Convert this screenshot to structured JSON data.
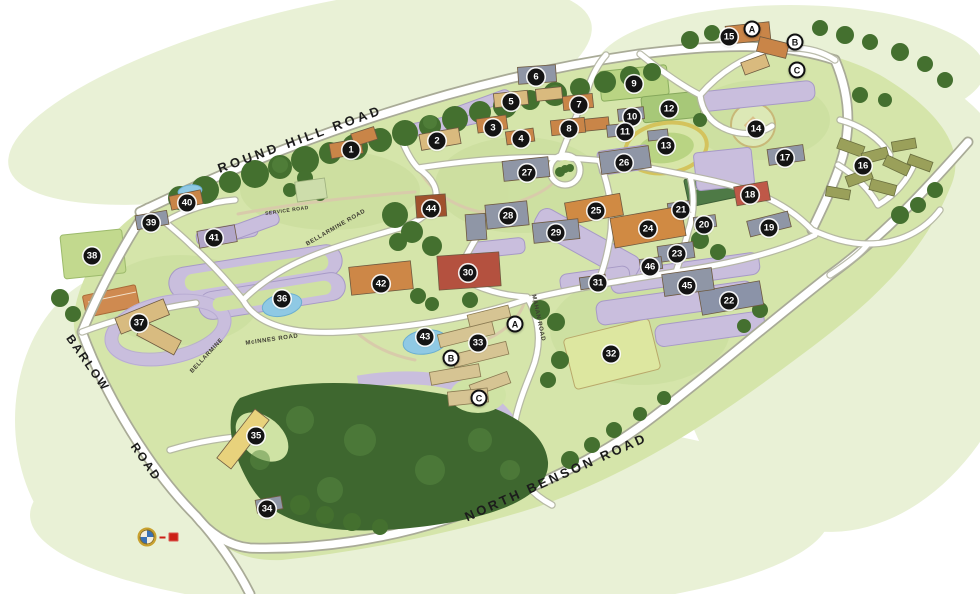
{
  "map": {
    "name": "illustrated-campus-map",
    "palette": {
      "wash": "#e9f1d6",
      "ground": "#d5e5aa",
      "forest": "#3e672f",
      "tree": "#44702f",
      "road_casing": "#a9ab97",
      "road": "#ffffff",
      "parking": "#c9bedd",
      "building_orange": "#c98548",
      "building_tan": "#d9ba7e",
      "building_slate": "#8f96a6",
      "building_red": "#bf5848",
      "pond": "#8fc9e4",
      "track": "#d4c35c",
      "marker_bg": "#141414"
    },
    "road_labels": [
      {
        "text": "ROUND HILL ROAD",
        "x": 300,
        "y": 139,
        "rot": -20,
        "size": 13,
        "spacing": 3.5,
        "cls": "major"
      },
      {
        "text": "NORTH BENSON ROAD",
        "x": 556,
        "y": 477,
        "rot": -24,
        "size": 13,
        "spacing": 3,
        "cls": "major"
      },
      {
        "text": "BARLOW",
        "x": 88,
        "y": 363,
        "rot": 55,
        "size": 12,
        "spacing": 2,
        "cls": "major"
      },
      {
        "text": "ROAD",
        "x": 146,
        "y": 462,
        "rot": 55,
        "size": 12,
        "spacing": 2,
        "cls": "major"
      },
      {
        "text": "BELLARMINE ROAD",
        "x": 336,
        "y": 228,
        "rot": -30,
        "size": 6,
        "spacing": 0.6,
        "cls": "minor"
      },
      {
        "text": "SERVICE ROAD",
        "x": 287,
        "y": 211,
        "rot": -8,
        "size": 5,
        "spacing": 0.5,
        "cls": "minor"
      },
      {
        "text": "BELLARMINE",
        "x": 207,
        "y": 356,
        "rot": -47,
        "size": 6,
        "spacing": 0.6,
        "cls": "minor"
      },
      {
        "text": "McINNES ROAD",
        "x": 272,
        "y": 340,
        "rot": -8,
        "size": 6,
        "spacing": 0.6,
        "cls": "minor"
      },
      {
        "text": "MAHAN ROAD",
        "x": 538,
        "y": 318,
        "rot": 78,
        "size": 6,
        "spacing": 0.6,
        "cls": "minor"
      }
    ],
    "markers": [
      {
        "label": "1",
        "x": 351,
        "y": 150,
        "type": "number"
      },
      {
        "label": "2",
        "x": 437,
        "y": 141,
        "type": "number"
      },
      {
        "label": "3",
        "x": 493,
        "y": 128,
        "type": "number"
      },
      {
        "label": "4",
        "x": 521,
        "y": 139,
        "type": "number"
      },
      {
        "label": "5",
        "x": 511,
        "y": 102,
        "type": "number"
      },
      {
        "label": "6",
        "x": 536,
        "y": 77,
        "type": "number"
      },
      {
        "label": "7",
        "x": 579,
        "y": 105,
        "type": "number"
      },
      {
        "label": "8",
        "x": 569,
        "y": 129,
        "type": "number"
      },
      {
        "label": "9",
        "x": 634,
        "y": 84,
        "type": "number"
      },
      {
        "label": "10",
        "x": 632,
        "y": 117,
        "type": "number"
      },
      {
        "label": "11",
        "x": 625,
        "y": 132,
        "type": "number"
      },
      {
        "label": "12",
        "x": 669,
        "y": 109,
        "type": "number"
      },
      {
        "label": "13",
        "x": 666,
        "y": 146,
        "type": "number"
      },
      {
        "label": "14",
        "x": 756,
        "y": 129,
        "type": "number"
      },
      {
        "label": "15",
        "x": 729,
        "y": 37,
        "type": "number"
      },
      {
        "label": "16",
        "x": 863,
        "y": 166,
        "type": "number"
      },
      {
        "label": "17",
        "x": 785,
        "y": 158,
        "type": "number"
      },
      {
        "label": "18",
        "x": 750,
        "y": 195,
        "type": "number"
      },
      {
        "label": "19",
        "x": 769,
        "y": 228,
        "type": "number"
      },
      {
        "label": "20",
        "x": 704,
        "y": 225,
        "type": "number"
      },
      {
        "label": "21",
        "x": 681,
        "y": 210,
        "type": "number"
      },
      {
        "label": "22",
        "x": 729,
        "y": 301,
        "type": "number"
      },
      {
        "label": "23",
        "x": 677,
        "y": 254,
        "type": "number"
      },
      {
        "label": "24",
        "x": 648,
        "y": 229,
        "type": "number"
      },
      {
        "label": "25",
        "x": 596,
        "y": 211,
        "type": "number"
      },
      {
        "label": "26",
        "x": 624,
        "y": 163,
        "type": "number"
      },
      {
        "label": "27",
        "x": 527,
        "y": 173,
        "type": "number"
      },
      {
        "label": "28",
        "x": 508,
        "y": 216,
        "type": "number"
      },
      {
        "label": "29",
        "x": 556,
        "y": 233,
        "type": "number"
      },
      {
        "label": "30",
        "x": 468,
        "y": 273,
        "type": "number"
      },
      {
        "label": "31",
        "x": 598,
        "y": 283,
        "type": "number"
      },
      {
        "label": "32",
        "x": 611,
        "y": 354,
        "type": "number"
      },
      {
        "label": "33",
        "x": 478,
        "y": 343,
        "type": "number"
      },
      {
        "label": "34",
        "x": 267,
        "y": 509,
        "type": "number"
      },
      {
        "label": "35",
        "x": 256,
        "y": 436,
        "type": "number"
      },
      {
        "label": "36",
        "x": 282,
        "y": 299,
        "type": "number"
      },
      {
        "label": "37",
        "x": 139,
        "y": 323,
        "type": "number"
      },
      {
        "label": "38",
        "x": 92,
        "y": 256,
        "type": "number"
      },
      {
        "label": "39",
        "x": 151,
        "y": 223,
        "type": "number"
      },
      {
        "label": "40",
        "x": 187,
        "y": 203,
        "type": "number"
      },
      {
        "label": "41",
        "x": 214,
        "y": 238,
        "type": "number"
      },
      {
        "label": "42",
        "x": 381,
        "y": 284,
        "type": "number"
      },
      {
        "label": "43",
        "x": 425,
        "y": 337,
        "type": "number"
      },
      {
        "label": "44",
        "x": 431,
        "y": 209,
        "type": "number"
      },
      {
        "label": "45",
        "x": 687,
        "y": 286,
        "type": "number"
      },
      {
        "label": "46",
        "x": 650,
        "y": 267,
        "type": "number"
      },
      {
        "label": "A",
        "x": 752,
        "y": 29,
        "type": "letter"
      },
      {
        "label": "B",
        "x": 795,
        "y": 42,
        "type": "letter"
      },
      {
        "label": "C",
        "x": 797,
        "y": 70,
        "type": "letter"
      },
      {
        "label": "A",
        "x": 515,
        "y": 324,
        "type": "letter"
      },
      {
        "label": "B",
        "x": 451,
        "y": 358,
        "type": "letter"
      },
      {
        "label": "C",
        "x": 479,
        "y": 398,
        "type": "letter"
      }
    ],
    "compass": {
      "x": 158,
      "y": 537
    }
  }
}
